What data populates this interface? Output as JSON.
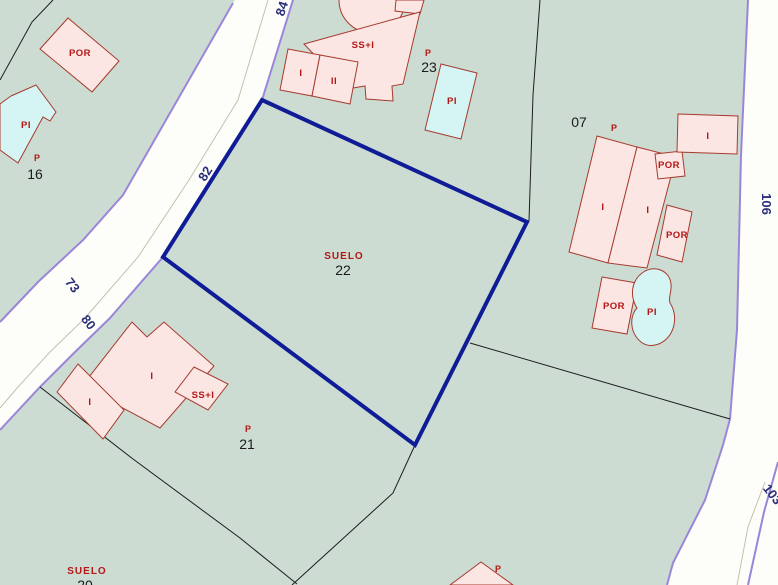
{
  "colors": {
    "parcel_background": "#ccdcd3",
    "road_surface": "#fdfdfa",
    "road_edge_purple": "#9a86d8",
    "road_centerline": "#c6c0ac",
    "building_fill": "#fce6e3",
    "building_stroke": "#a63a2d",
    "pool_fill": "#d5f4f4",
    "parcel_boundary": "#1c1c1c",
    "selected_parcel_outline": "#0f1c96",
    "building_label_red": "#b51616",
    "parcel_number_black": "#1a1a1a",
    "road_number_navy": "#2a2f78"
  },
  "selection": {
    "parcel_number": "22",
    "land_use": "SUELO"
  },
  "labels": {
    "parcel16_por": "POR",
    "parcel16_pool": "PI",
    "parcel16_p": "P",
    "parcel16_number": "16",
    "parcel23_building": "SS+I",
    "parcel23_room_i": "I",
    "parcel23_room_ii": "II",
    "parcel23_p": "P",
    "parcel23_number": "23",
    "parcel23_pool": "PI",
    "parcel22_land_use": "SUELO",
    "parcel22_number": "22",
    "parcel07_number": "07",
    "parcel07_p": "P",
    "parcel07_building_i_left": "I",
    "parcel07_building_i_right": "I",
    "parcel07_por_top": "POR",
    "parcel07_por_wing": "POR",
    "parcel07_building_i_ne": "I",
    "parcel07_por_low": "POR",
    "parcel07_pool": "PI",
    "parcel21_building_i_main": "I",
    "parcel21_building_i_small": "I",
    "parcel21_building_ssi": "SS+I",
    "parcel21_p": "P",
    "parcel21_number": "21",
    "parcel20_land_use": "SUELO",
    "parcel20_number": "20",
    "parcel_bottom_p": "P",
    "road_number_84": "84",
    "road_number_82": "82",
    "road_number_73": "73",
    "road_number_80": "80",
    "road_number_106": "106",
    "road_number_103": "103"
  }
}
